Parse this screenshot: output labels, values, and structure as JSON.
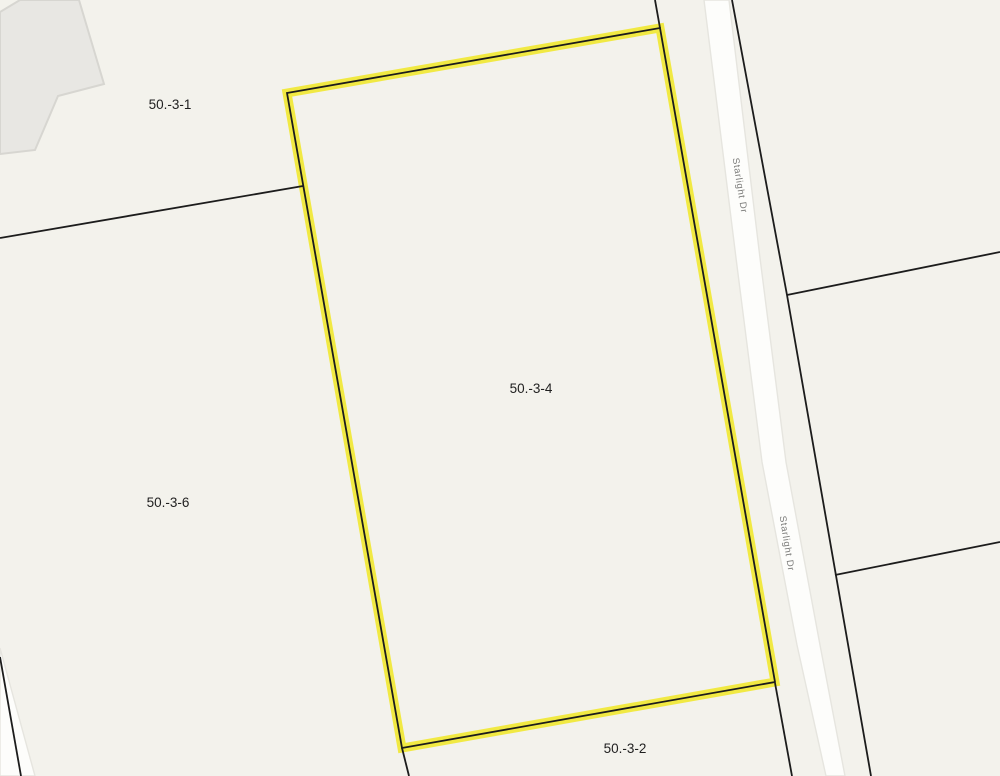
{
  "map": {
    "type": "tax-parcel-map",
    "parcels": [
      {
        "id": "50.-3-1",
        "highlighted": false
      },
      {
        "id": "50.-3-6",
        "highlighted": false
      },
      {
        "id": "50.-3-4",
        "highlighted": true
      },
      {
        "id": "50.-3-2",
        "highlighted": false
      }
    ],
    "road_labels": [
      {
        "name": "Starlight Dr"
      },
      {
        "name": "Starlight Dr"
      }
    ],
    "colors": {
      "background": "#f3f2ec",
      "parcel_line": "#1c1c1c",
      "highlight": "#f0e83a",
      "road_fill": "#fdfdfb",
      "road_casing": "#e6e5df",
      "building_fill": "#e8e7e3",
      "building_stroke": "#d7d6d1",
      "label": "#1f1f1f",
      "road_label": "#7c7c7a"
    }
  }
}
